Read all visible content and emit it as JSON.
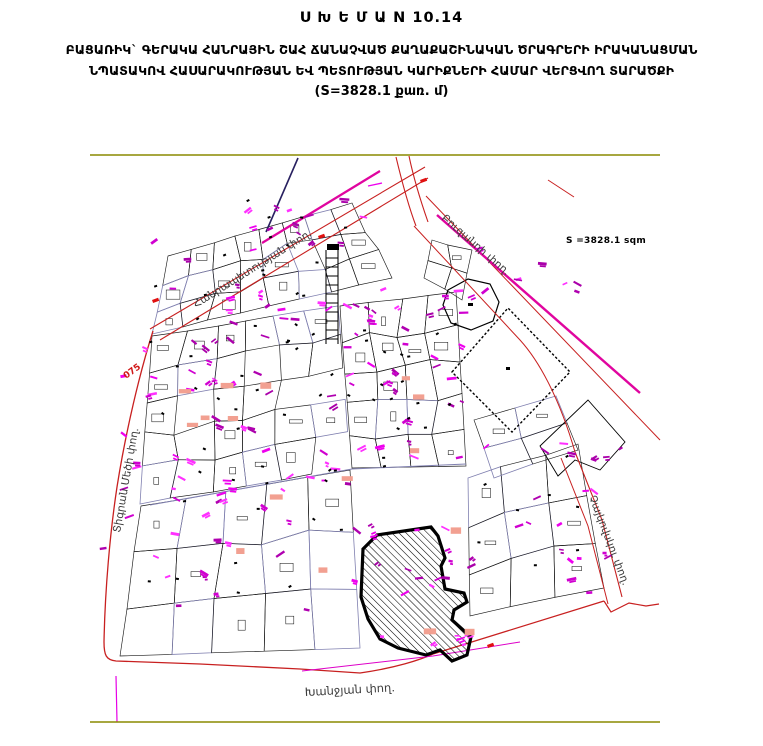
{
  "header": {
    "title": "Ս Խ Ե Մ Ա N 10.14",
    "line1": "ԲԱՑԱՌԻԿ` ԳԵՐԱԿԱ ՀԱՆՐԱՅԻՆ ՇԱՀ ՃԱՆԱՉՎԱԾ ՔԱՂԱՔԱՇԻՆԱԿԱՆ ԾՐԱԳՐԵՐԻ ԻՐԱԿԱՆԱՑՄԱՆ",
    "line2": "ՆՊԱՏԱԿՈՎ ՀԱՍԱՐԱԿՈՒԹՅԱՆ ԵՎ ՊԵՏՈՒԹՅԱՆ ԿԱՐԻՔՆԵՐԻ ՀԱՄԱՐ ՎԵՐՑՎՈՂ ՏԱՐԱԾՔԻ",
    "line3": "(S=3828.1 քառ. մ)"
  },
  "map": {
    "area_label": "S =3828.1 sqm",
    "parcel_code": "075",
    "streets": {
      "hanrapetutyan": "Հանրապետության փող.",
      "buzand": "Բուզանդի փող.",
      "tigran_mets": "Տիգրան Մեծի փող.",
      "tchaikovsky": "Չայկովսկու փող.",
      "khanjyan": "Խանջյան փող."
    },
    "colors": {
      "street_red": "#c82020",
      "street_magenta": "#e0059f",
      "label_magenta": "#ee00ee",
      "boundary_olive": "#8a8a00",
      "salmon_fill": "#f2a091",
      "red_mark": "#e01010"
    }
  }
}
